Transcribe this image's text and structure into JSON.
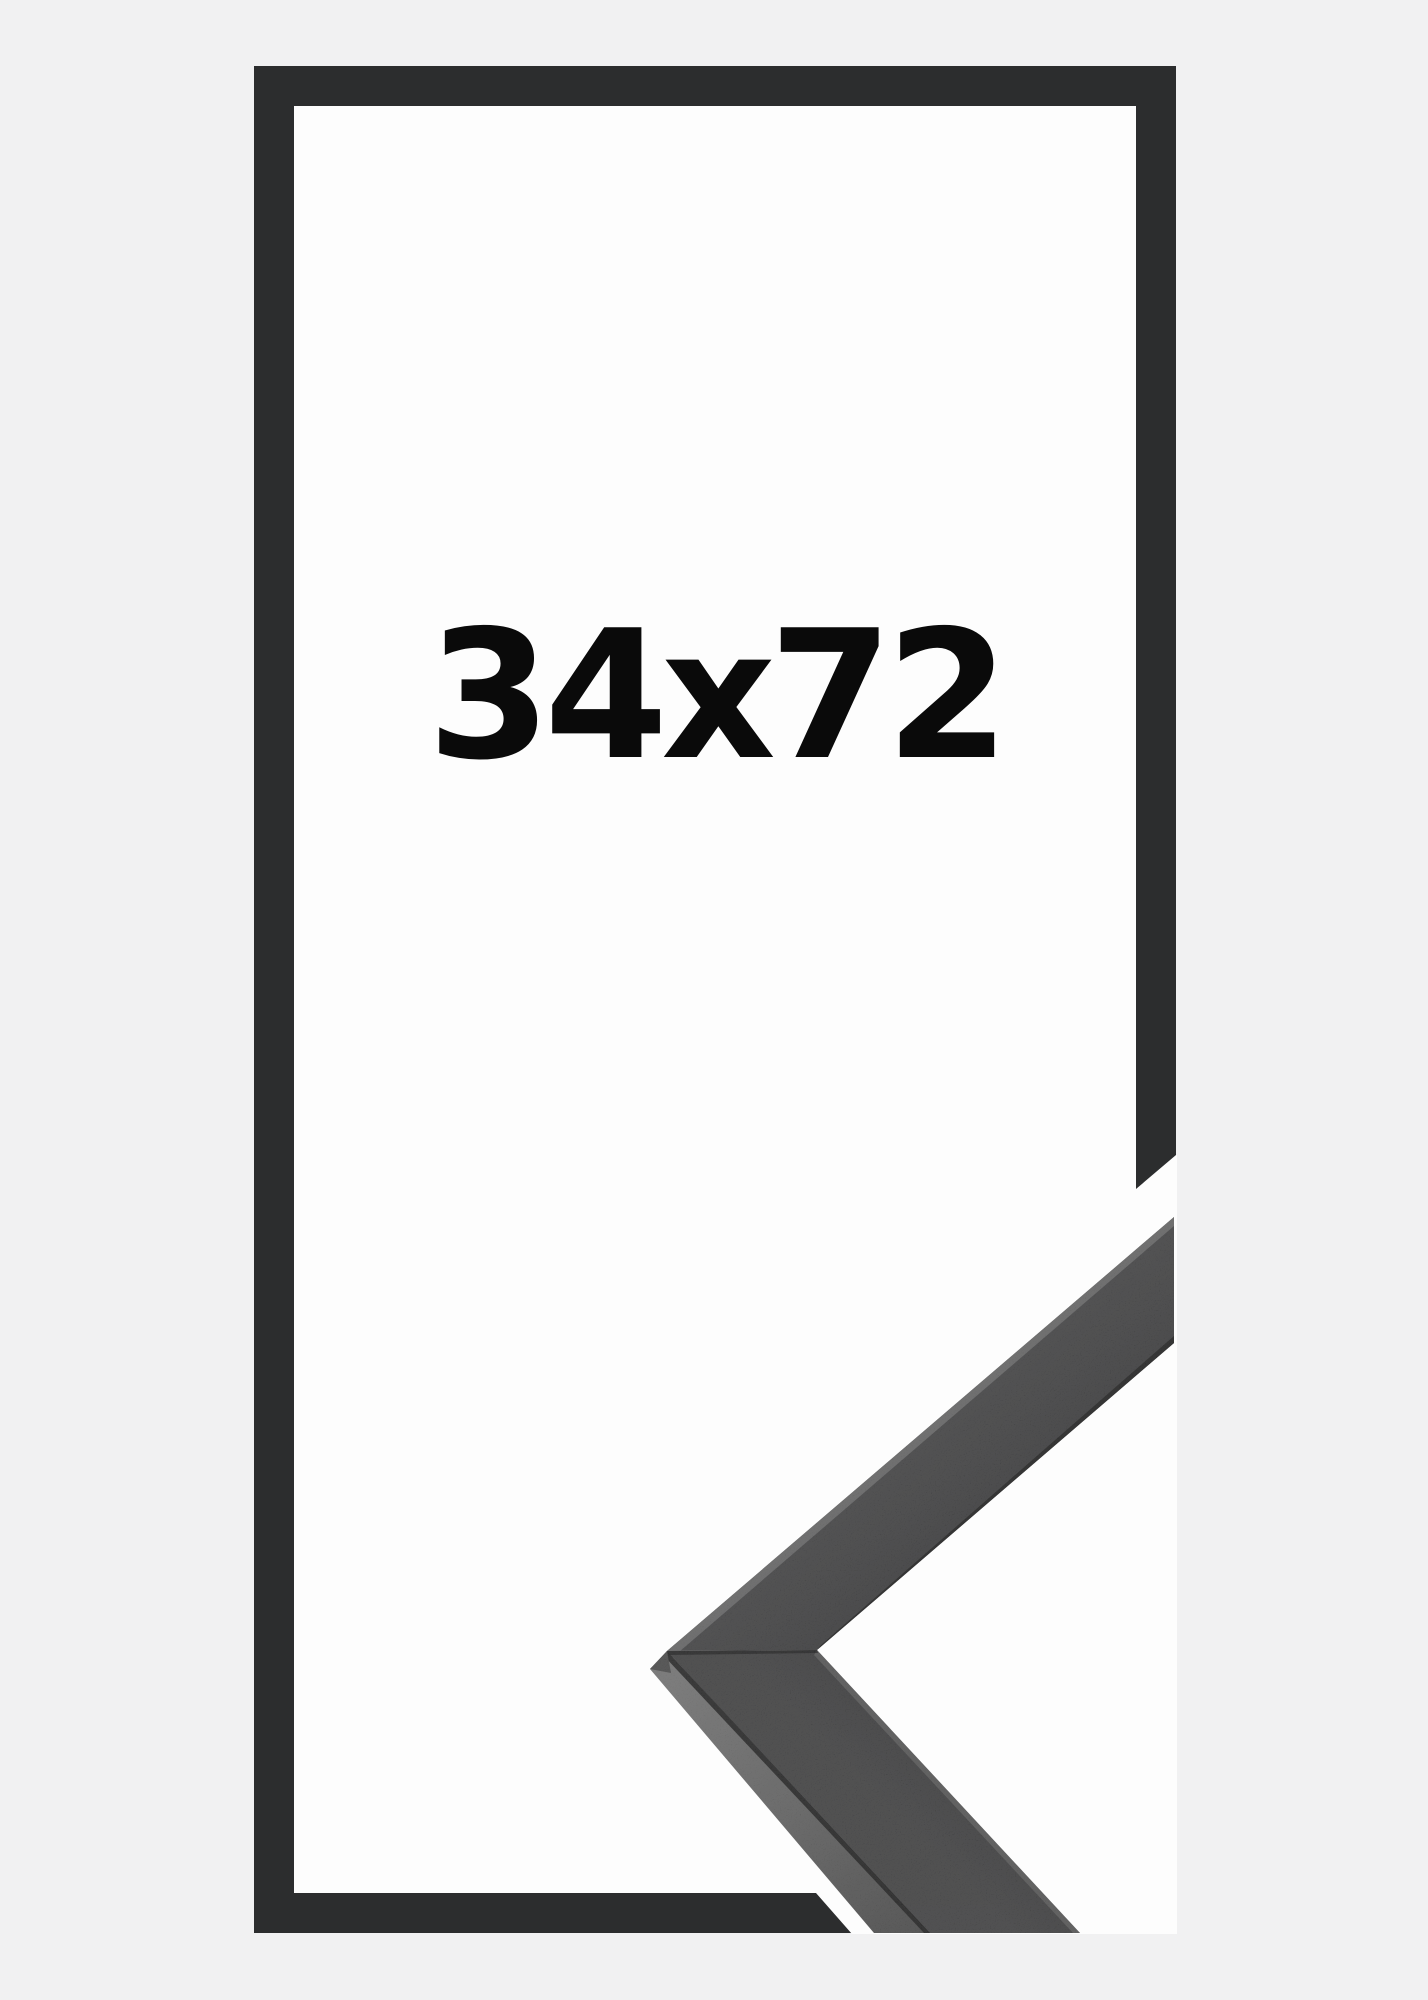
{
  "product_image": {
    "size_label": "34x72"
  },
  "frame_graphic": {
    "shape": "rectangular-outline",
    "corner_detail": "mitered-corner-closeup-photo"
  },
  "colors": {
    "bg": "#f1f1f2",
    "outline": "#2c2d2e",
    "interior": "#fdfdfd",
    "label": "#0a0a0a",
    "face": "#353536",
    "face-dark": "#2d2d2e",
    "edge-highlight": "#606060",
    "edge-shadow": "#1b1b1b",
    "side-face": "#5f5f5f",
    "side-face-dark": "#424242",
    "seam": "#141414"
  }
}
